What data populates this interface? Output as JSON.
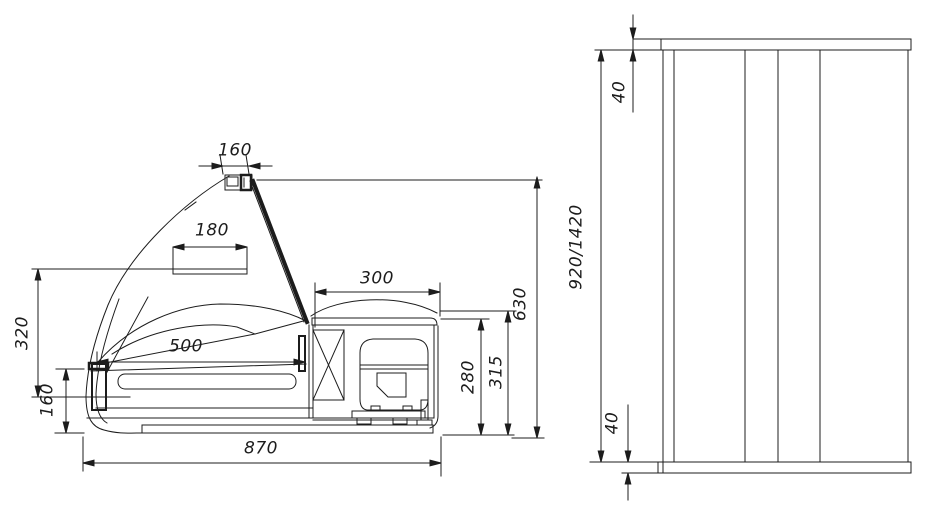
{
  "page": {
    "background_color": "#ffffff",
    "line_color": "#1c1c1c",
    "description": "Technical dimension drawing of a counter-top refrigerated display case: side section view and end elevation view"
  },
  "side_view": {
    "name": "side-section-view",
    "dimensions": {
      "lamp_width": "160",
      "sign_board_width": "180",
      "machine_compartment_width": "300",
      "display_well_width": "500",
      "canopy_to_worktop_height": "320",
      "front_panel_height": "160",
      "overall_depth": "870",
      "machine_compartment_height": "280",
      "machine_compartment_overall_height": "315",
      "overall_body_height": "630"
    }
  },
  "front_view": {
    "name": "end-elevation-view",
    "dimensions": {
      "countertop_thickness": "40",
      "body_height_options": "920/1420",
      "base_thickness": "40"
    }
  }
}
